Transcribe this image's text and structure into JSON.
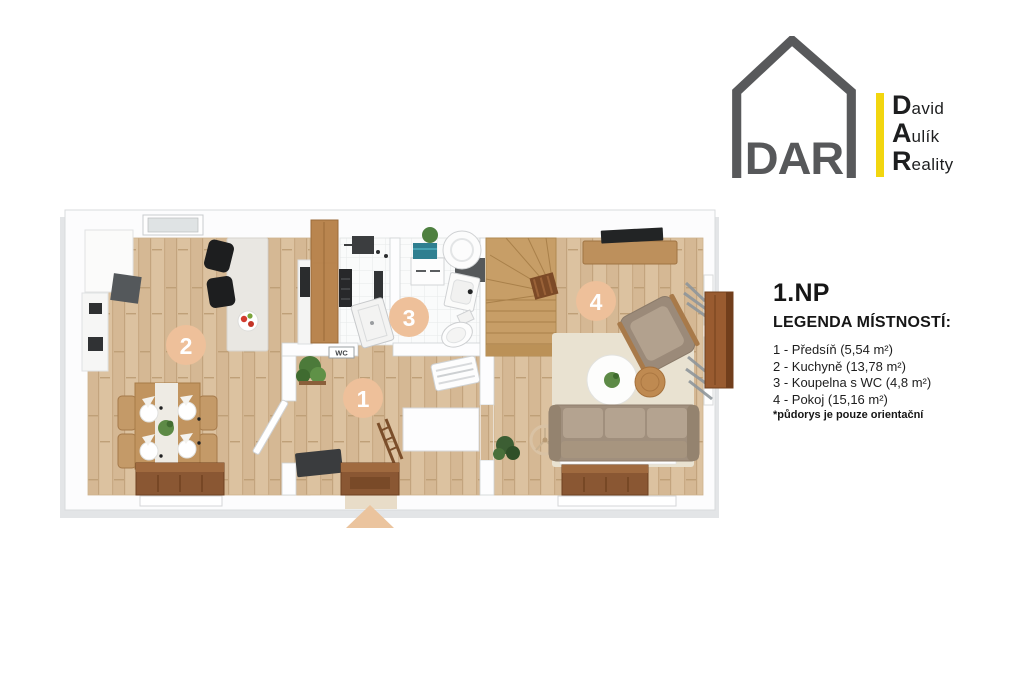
{
  "logo": {
    "monogram": "DAR",
    "company": [
      {
        "initial": "D",
        "rest": "avid"
      },
      {
        "initial": "A",
        "rest": "ulík"
      },
      {
        "initial": "R",
        "rest": "eality"
      }
    ]
  },
  "legend": {
    "floor_title": "1.NP",
    "heading": "LEGENDA MÍSTNOSTÍ:",
    "rooms": [
      {
        "number": "1",
        "label": "1 - Předsíň (5,54 m²)"
      },
      {
        "number": "2",
        "label": "2 - Kuchyně (13,78 m²)"
      },
      {
        "number": "3",
        "label": "3 - Koupelna s WC (4,8 m²)"
      },
      {
        "number": "4",
        "label": "4 - Pokoj (15,16 m²)"
      }
    ],
    "footnote": "*půdorys je pouze orientační"
  },
  "floorplan": {
    "wc_sign": "WC",
    "colors": {
      "room_badge": "#eec09a",
      "entrance_marker": "#ebc49e",
      "wood_floor": "#dcc2a0",
      "bathroom_tile": "#fafbfb",
      "logo_gray": "#58595b",
      "logo_yellow": "#f2d60f"
    }
  }
}
